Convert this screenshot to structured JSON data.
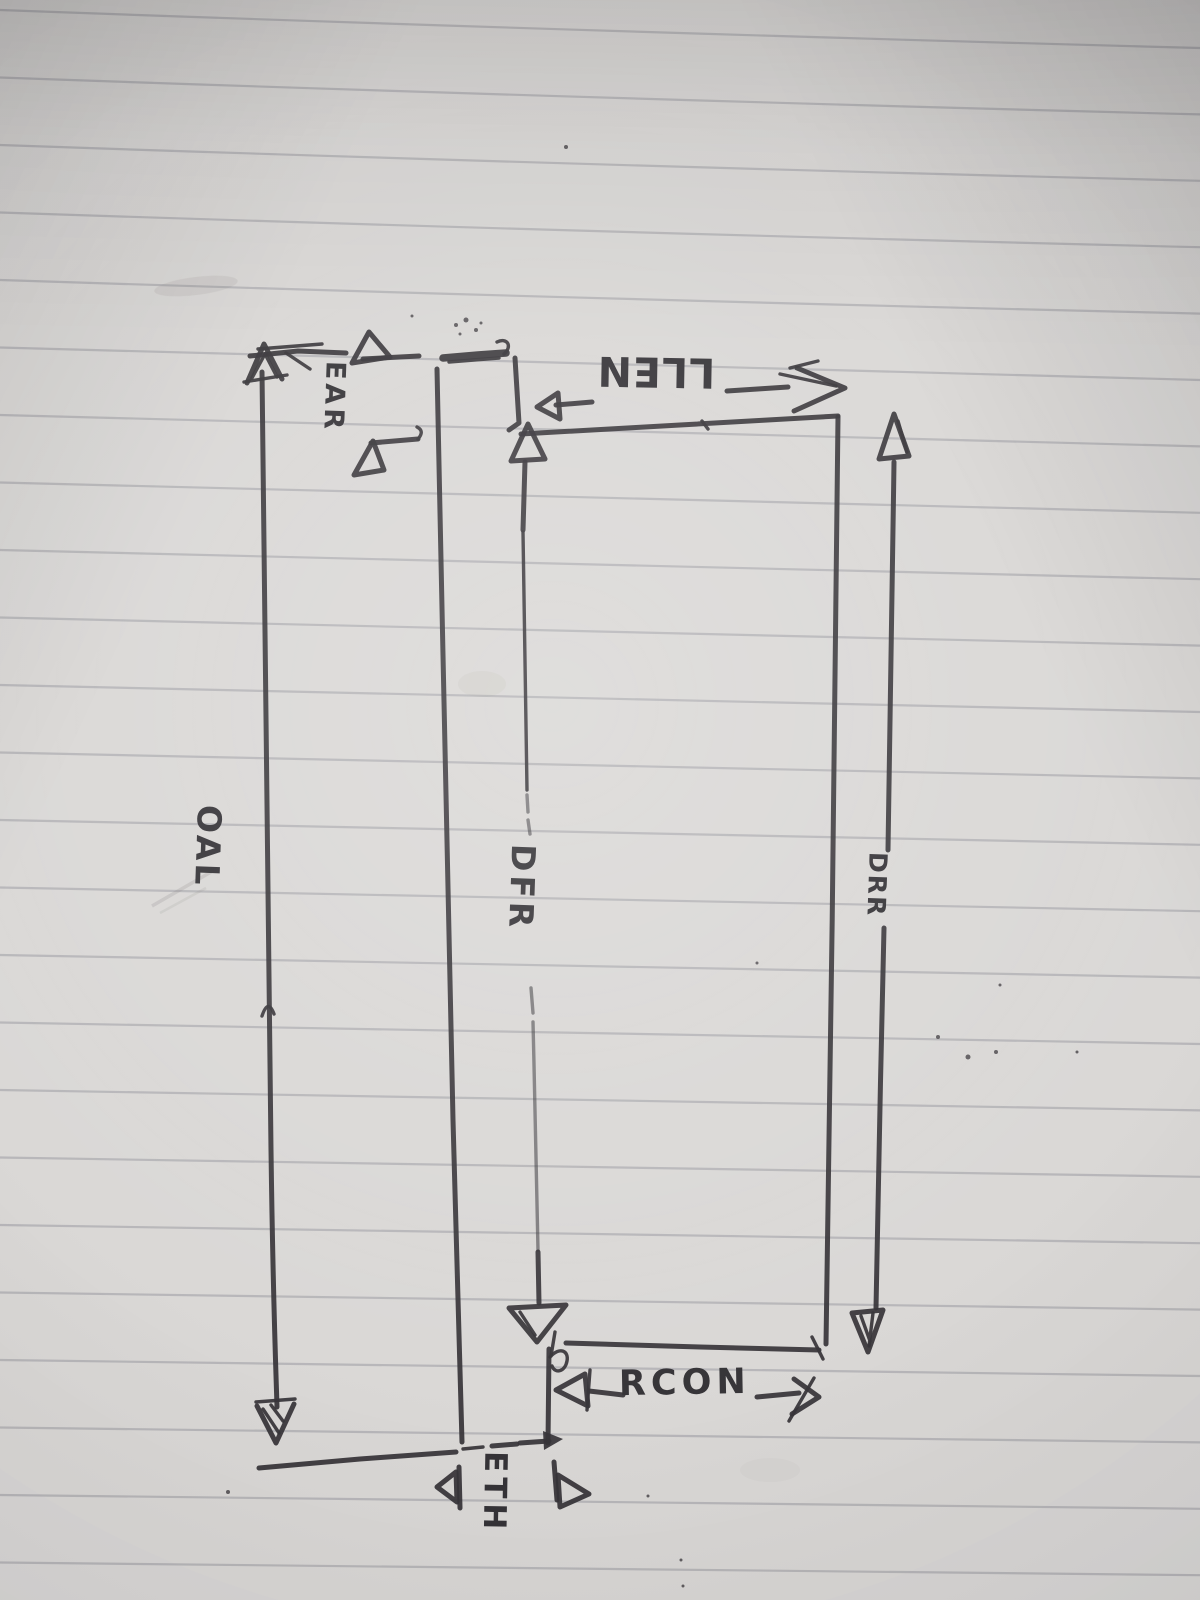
{
  "scene": {
    "description": "Hand-drawn engineering dimension sketch in black ink on gray lined notebook paper, photographed rotated on its side",
    "ink_color": "#2c2a2e",
    "paper_color": "#d8d6d4",
    "rule_line_color": "#8f9098"
  },
  "labels": {
    "oal": "OAL",
    "ear": "EAR",
    "llen": "LLEN",
    "dfr": "DFR",
    "drr": "DRR",
    "rcon": "RCON",
    "eth": "ETH"
  },
  "dimensions": [
    {
      "label": "OAL",
      "orientation": "vertical-in-photo",
      "style": "leftmost full-length double-headed dimension arrow between top and bottom reference lines"
    },
    {
      "label": "EAR",
      "orientation": "vertical-in-photo",
      "style": "short dimension at top-left, two open arrowheads pointing apart"
    },
    {
      "label": "LLEN",
      "orientation": "horizontal-in-photo",
      "style": "dimension along top edge of outline, lettering written upside down so it reads like N377"
    },
    {
      "label": "DFR",
      "orientation": "vertical-in-photo",
      "style": "center dimension line with large open arrowheads at top and bottom edges, dashed around label"
    },
    {
      "label": "DRR",
      "orientation": "vertical-in-photo",
      "style": "right-hand full-height dimension line with open arrowheads"
    },
    {
      "label": "RCON",
      "orientation": "horizontal-in-photo",
      "style": "dimension below bottom edge, open arrowheads pointing apart"
    },
    {
      "label": "ETH",
      "orientation": "vertical-in-photo",
      "style": "small dimension at bottom tab, outward pointing arrowheads with extension ticks"
    }
  ]
}
